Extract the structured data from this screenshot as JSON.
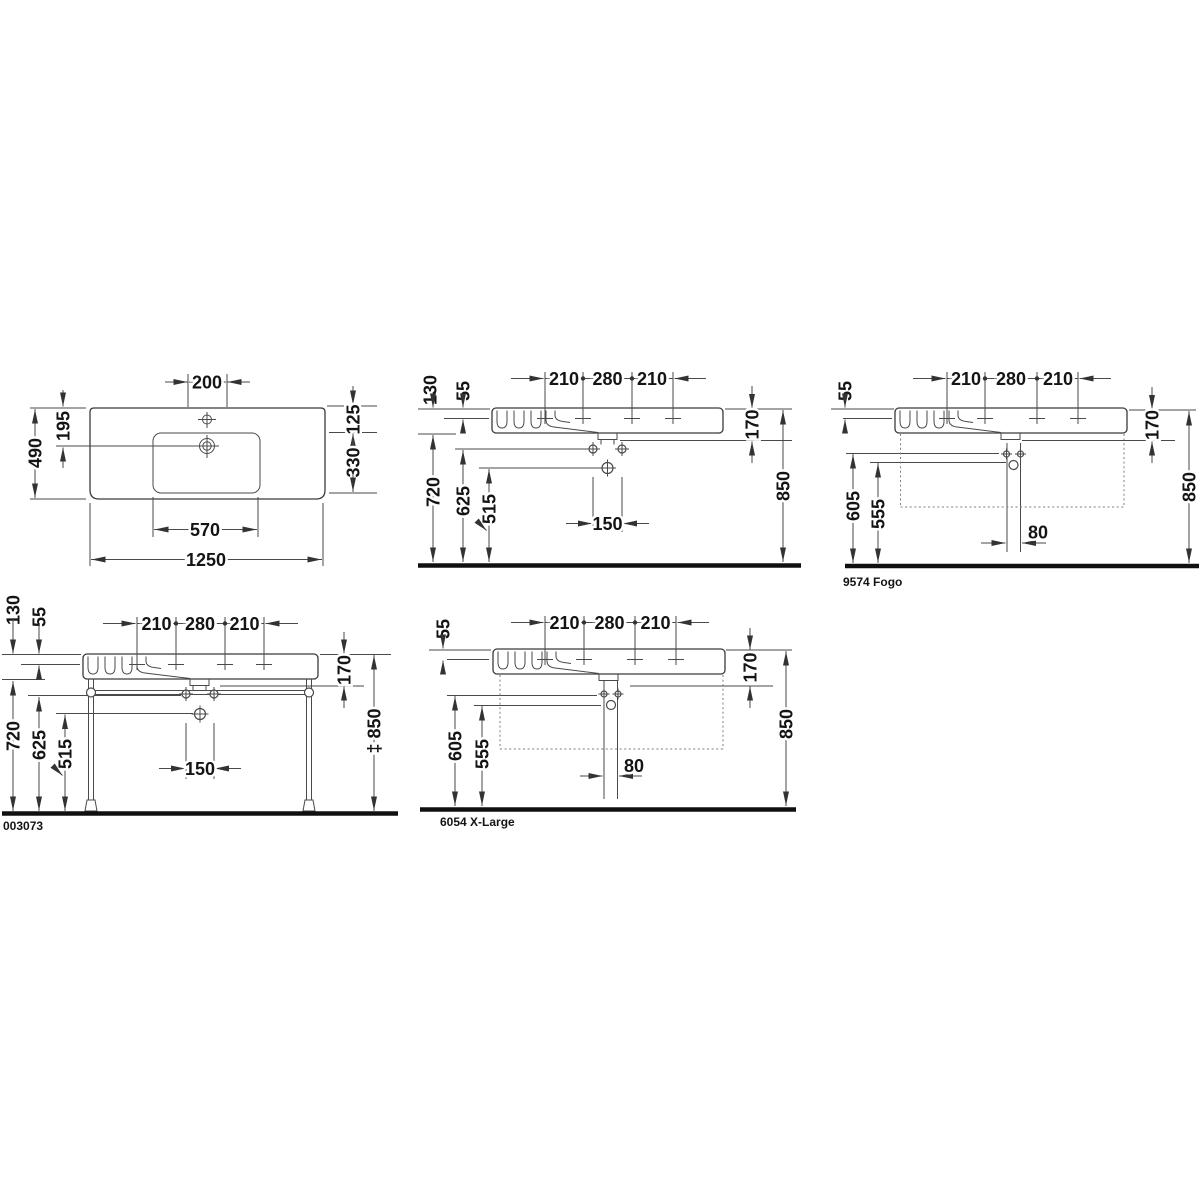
{
  "drawings": {
    "plan": {
      "tap_platform_width": "200",
      "overall_depth": "490",
      "rear_to_drain": "195",
      "rear_to_basin": "125",
      "basin_depth": "330",
      "basin_width": "570",
      "overall_width": "1250"
    },
    "wall_mounted": {
      "tap_left": "210",
      "tap_center": "280",
      "tap_right": "210",
      "front_height": "130",
      "tap_drop": "55",
      "underside_height": "720",
      "fixing_height": "625",
      "drain_height": "515",
      "fixing_spacing": "150",
      "body_height": "170",
      "rim_height": "850"
    },
    "fogo": {
      "caption": "9574 Fogo",
      "tap_left": "210",
      "tap_center": "280",
      "tap_right": "210",
      "tap_drop": "55",
      "fixing_height": "605",
      "drain_height": "555",
      "pipe_spacing": "80",
      "body_height": "170",
      "rim_height": "850"
    },
    "console": {
      "caption": "003073",
      "tap_left": "210",
      "tap_center": "280",
      "tap_right": "210",
      "front_height": "130",
      "tap_drop": "55",
      "underside_height": "720",
      "fixing_height": "625",
      "drain_height": "515",
      "fixing_spacing": "150",
      "body_height": "170",
      "rim_height": "‡ 850"
    },
    "xlarge": {
      "caption": "6054 X-Large",
      "tap_left": "210",
      "tap_center": "280",
      "tap_right": "210",
      "tap_drop": "55",
      "fixing_height": "605",
      "drain_height": "555",
      "pipe_spacing": "80",
      "body_height": "170",
      "rim_height": "850"
    }
  }
}
